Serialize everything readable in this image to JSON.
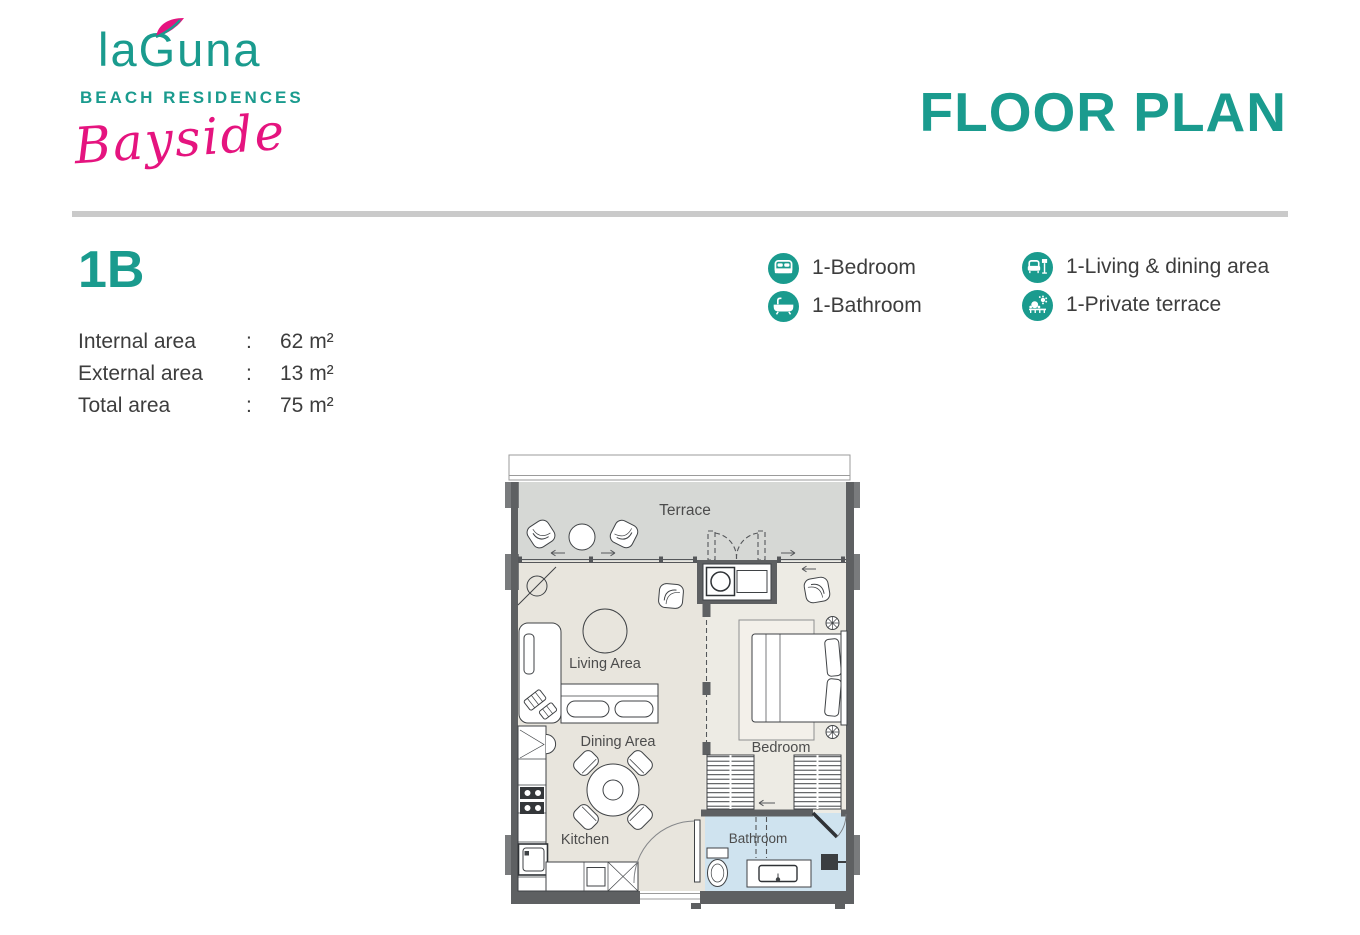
{
  "brand": {
    "name": "laGuna",
    "tagline": "BEACH RESIDENCES",
    "collection": "Bayside"
  },
  "header": {
    "title": "FLOOR PLAN"
  },
  "unit": {
    "code": "1B",
    "areas": [
      {
        "label": "Internal area",
        "separator": ":",
        "value": "62 m²"
      },
      {
        "label": "External area",
        "separator": ":",
        "value": "13 m²"
      },
      {
        "label": "Total area",
        "separator": ":",
        "value": "75 m²"
      }
    ]
  },
  "legend": {
    "items": [
      {
        "icon": "bed-icon",
        "label": "1-Bedroom"
      },
      {
        "icon": "bathtub-icon",
        "label": "1-Bathroom"
      },
      {
        "icon": "sofa-lamp-icon",
        "label": "1-Living & dining area"
      },
      {
        "icon": "terrace-icon",
        "label": "1-Private terrace"
      }
    ]
  },
  "floorplan": {
    "rooms": {
      "terrace": "Terrace",
      "living": "Living Area",
      "dining": "Dining Area",
      "kitchen": "Kitchen",
      "bedroom": "Bedroom",
      "bathroom": "Bathroom"
    }
  },
  "colors": {
    "teal": "#1a9b8e",
    "pink": "#e5147f",
    "text": "#3d3d3d",
    "divider": "#cacaca",
    "wall": "#5e6062",
    "terrace_floor": "#d6d8d5",
    "interior_floor": "#e8e5dd",
    "bedroom_floor": "#edebe4",
    "bathroom_floor": "#cfe3ef"
  }
}
